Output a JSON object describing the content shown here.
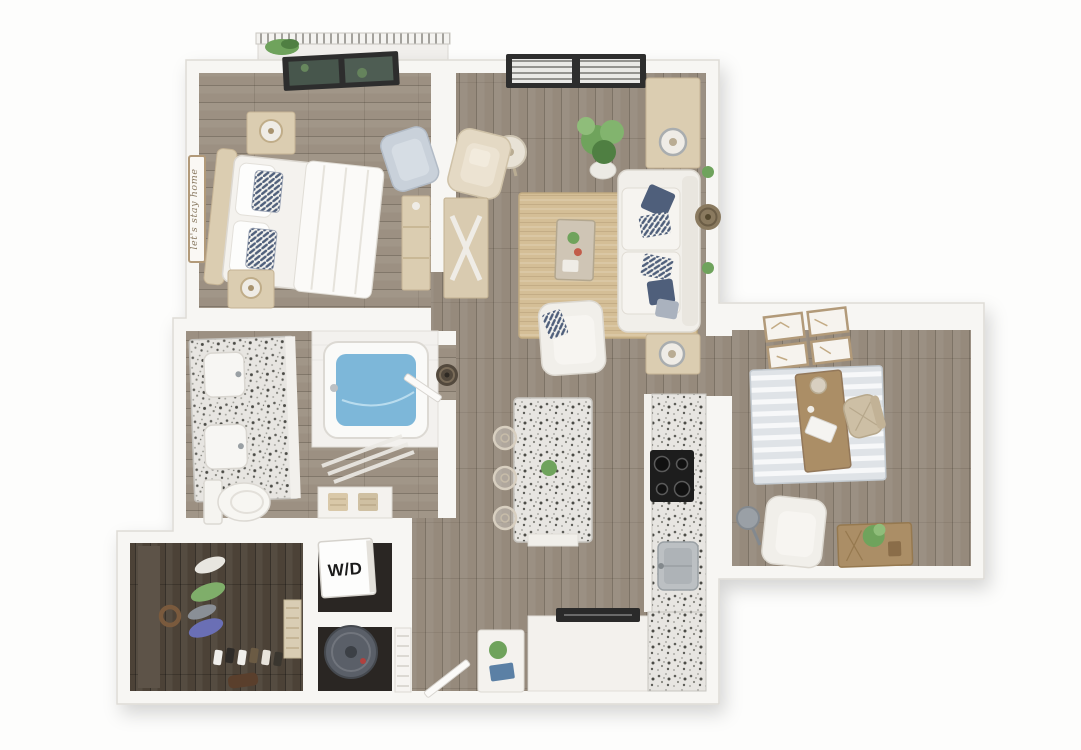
{
  "scene": {
    "type": "3d-apartment-floor-plan-render",
    "labels": {
      "washer_dryer": "W/D",
      "bedroom_wall_sign": "let's stay home"
    },
    "colors": {
      "page_bg": "#fdfdfc",
      "wall": "#f7f6f3",
      "wall_edge": "#dedbd6",
      "floor_wood": "#968a7c",
      "floor_wood_bed": "#9c9082",
      "floor_closet": "#4c4237",
      "floor_utility": "#2a2623",
      "rug_jute": "#d4be96",
      "rug_office": "#dfe3e7",
      "sofa_white": "#f1efea",
      "cushion_navy": "#4f5f7b",
      "furniture_tan": "#dbcdb1",
      "furniture_wood": "#ab8e66",
      "granite": "#e7e5e1",
      "water_blue": "#7db7d9",
      "plant_green": "#6fa35c",
      "plant_green_dark": "#4f7f42",
      "window_frame": "#2d2d2d",
      "appliance_gray": "#5a5f68",
      "cooktop_black": "#1d1d1d",
      "steel": "#bcc0c3",
      "door_white": "#fbfaf8"
    }
  }
}
